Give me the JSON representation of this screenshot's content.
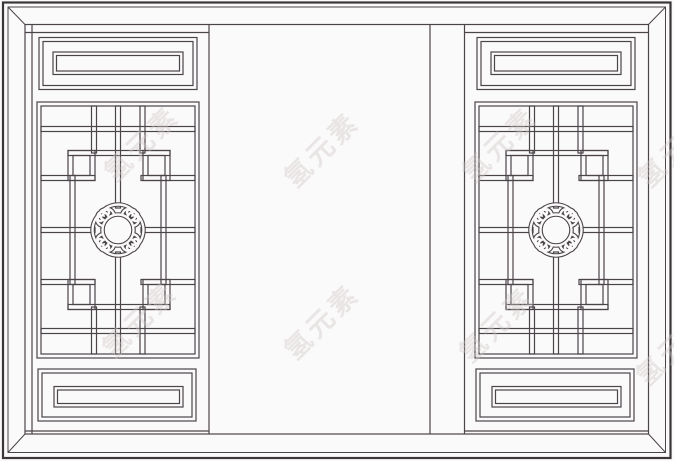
{
  "illustration": {
    "description": "Line drawing of a traditional Chinese lattice window: two carved wooden sashes with cloud medallion lattice panels flanking an open centre pane",
    "background_color": "#fbfafa",
    "line_color": "#4b4449",
    "heavy_line_color": "#3b363a"
  },
  "watermark": {
    "text": "氢元素",
    "color": "#cfc8c8",
    "count": 8
  }
}
